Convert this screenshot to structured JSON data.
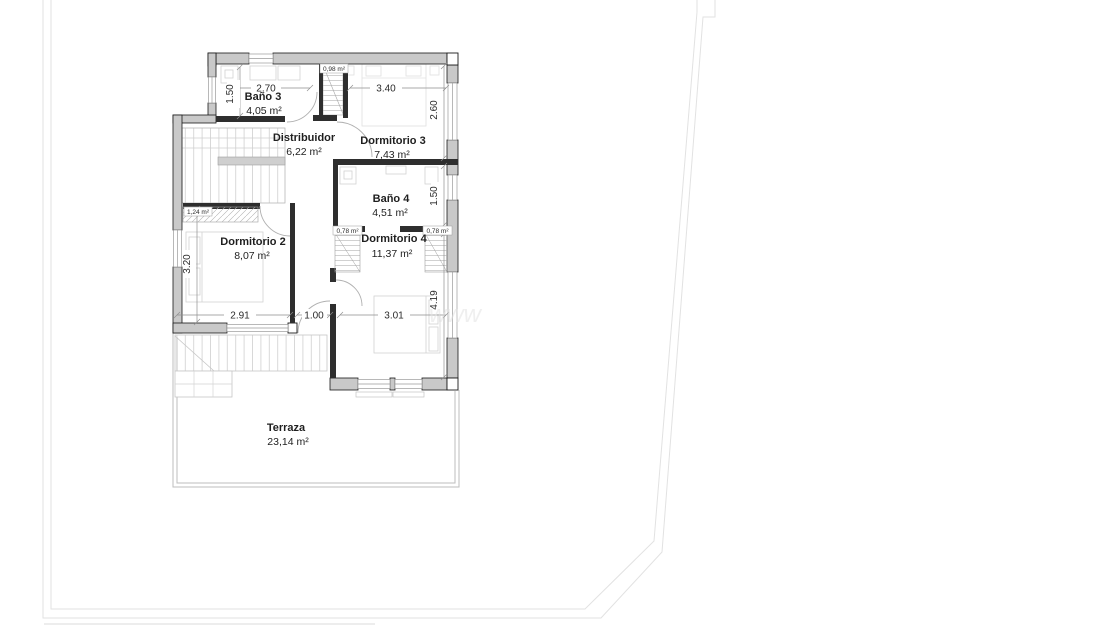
{
  "rooms": {
    "bano3": {
      "name": "Baño 3",
      "area": "4,05 m²"
    },
    "distribuidor": {
      "name": "Distribuidor",
      "area": "6,22 m²"
    },
    "dormitorio3": {
      "name": "Dormitorio 3",
      "area": "7,43 m²"
    },
    "bano4": {
      "name": "Baño 4",
      "area": "4,51 m²"
    },
    "dormitorio2": {
      "name": "Dormitorio 2",
      "area": "8,07 m²"
    },
    "dormitorio4": {
      "name": "Dormitorio 4",
      "area": "11,37 m²"
    },
    "terraza": {
      "name": "Terraza",
      "area": "23,14 m²"
    }
  },
  "annotations": {
    "stairwell_area": "0,98 m²",
    "wardrobe_area": "1,24 m²",
    "closet_left_area": "0,78 m²",
    "closet_right_area": "0,78 m²"
  },
  "dimensions": {
    "bano3_width": "2.70",
    "bano3_depth": "1.50",
    "dormitorio3_width": "3.40",
    "dormitorio3_depth": "2.60",
    "bano4_depth": "1.50",
    "dormitorio2_depth": "3.20",
    "dormitorio2_width": "2.91",
    "terrace_door_width": "1.00",
    "dormitorio4_width": "3.01",
    "dormitorio4_depth": "4.19"
  },
  "watermark": "www",
  "colors": {
    "wall_fill": "#c9c9c9",
    "partition": "#2e2e2e",
    "wall_stroke": "#1a1a1a",
    "dim_line": "#8f8f8f",
    "boundary": "#e2e2e2",
    "background": "#ffffff"
  }
}
